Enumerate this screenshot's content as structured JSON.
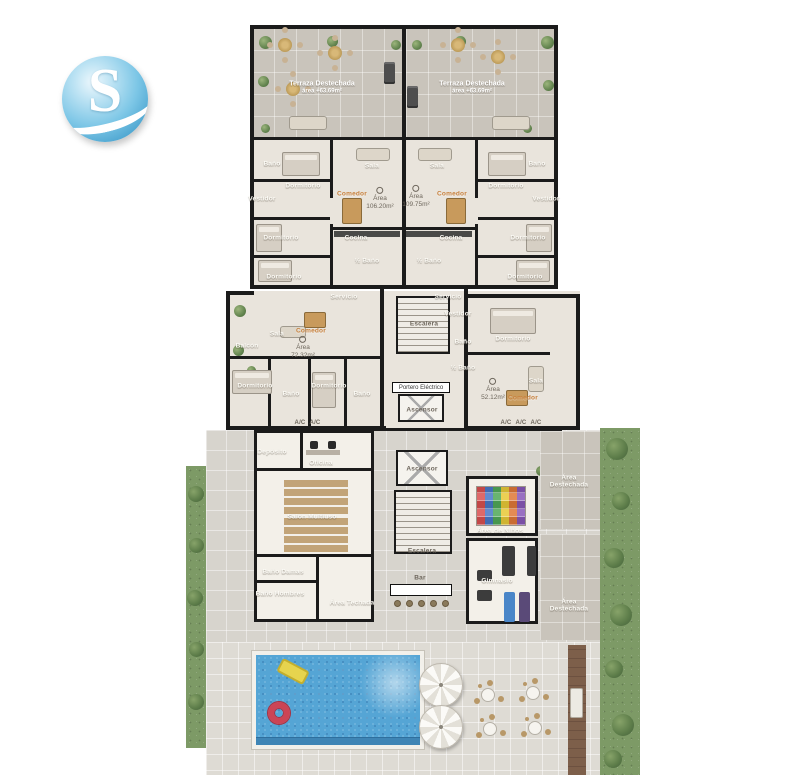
{
  "logo": {
    "letter": "S"
  },
  "plan": {
    "terraces": {
      "left": {
        "name": "Terraza Destechada",
        "area": "área +63.69m²"
      },
      "right": {
        "name": "Terraza Destechada",
        "area": "área +63.69m²"
      }
    },
    "rooms": {
      "banio": "Baño",
      "medio_banio": "½ Baño",
      "dormitorio": "Dormitorio",
      "vestidor": "Vestidor",
      "sala": "Sala",
      "comedor": "Comedor",
      "cocina": "Cocina",
      "servicio": "Servicio",
      "balcon": "Balcón",
      "escalera": "Escalera",
      "ascensor": "Ascensor",
      "portero_electrico": "Portero Eléctrico",
      "deposito": "Depósito",
      "oficina": "Oficina",
      "salon_multiuso": "Salón Multiuso",
      "banio_damas": "Baño Damas",
      "banio_hombres": "Baño Hombres",
      "bar": "Bar",
      "gimnasio": "Gimnasio",
      "area_ninos": "Área de Niños",
      "area_techada": "Área Techada",
      "area_destechada": "Área Destechada",
      "ac": "A/C"
    },
    "areas": {
      "label": "Área",
      "unit_top_left": "106.20m²",
      "unit_top_right": "109.75m²",
      "unit_mid_left": "72.32m²",
      "unit_mid_right": "52.12m²"
    },
    "colors": {
      "wall": "#1b1b1b",
      "floor": "#e9e4dc",
      "terrace_tile": "#c9c4bb",
      "paving": "#d7d4cd",
      "pool_water": "#55a5d5",
      "hedge": "#7d9a66",
      "logo_blue": "#6ec0e4",
      "accent_orange": "#c8803c"
    }
  }
}
